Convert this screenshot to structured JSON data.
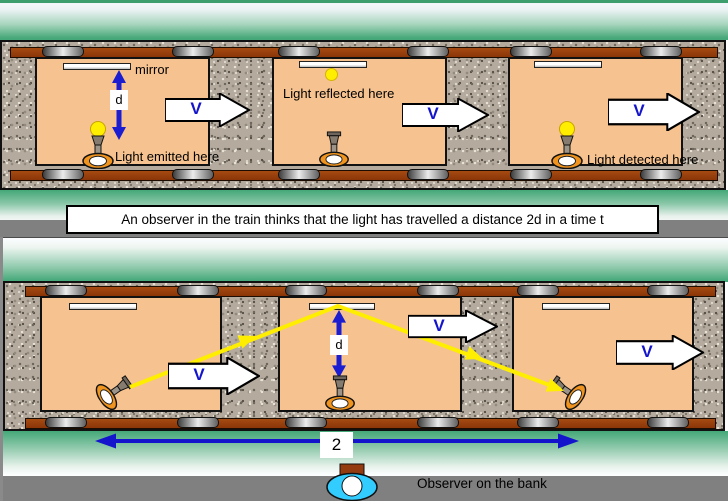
{
  "caption": "An observer in the train thinks that the light has travelled a distance 2d in a time t",
  "labels": {
    "mirror": "mirror",
    "d": "d",
    "v": "V",
    "light_emitted": "Light emitted here",
    "light_reflected": "Light reflected here",
    "light_detected": "Light detected here",
    "bank_distance": "2",
    "observer": "Observer on the bank"
  },
  "icons": {
    "lamp": "signal-lamp-icon",
    "bulb": "light-bulb-icon",
    "light_flash": "light-flash-icon",
    "mirror_bar": "mirror-icon",
    "wheel": "train-wheel-icon",
    "velocity_arrow": "velocity-block-arrow-icon",
    "distance_arrow": "distance-double-arrow-icon",
    "light_ray": "light-ray-arrow-icon",
    "observer": "observer-eye-icon"
  },
  "colors": {
    "sky_green": "#44a878",
    "band_gray": "#808080",
    "carriage_fill": "#f6c28f",
    "rail_brown": "#943d0c",
    "ballast_gray": "#b4ab9e",
    "arrow_blue": "#1414cc",
    "ray_yellow": "#ffee00",
    "lamp_orange": "#f0941e",
    "observer_cyan": "#33ccff"
  }
}
